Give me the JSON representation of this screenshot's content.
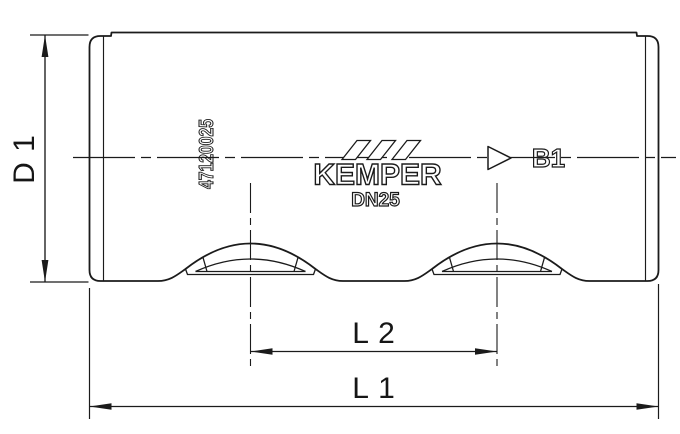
{
  "labels": {
    "diameter": "D 1",
    "overall_length": "L 1",
    "port_distance": "L 2",
    "flow_port": "B1"
  },
  "markings": {
    "part_number": "47120025",
    "brand": "KEMPER",
    "nominal_diameter": "DN25"
  },
  "icons": {
    "flow_direction": "flow-direction-icon",
    "brand_slashes": "brand-slashes-icon"
  },
  "colors": {
    "line": "#1b1b1b",
    "background": "#ffffff"
  }
}
